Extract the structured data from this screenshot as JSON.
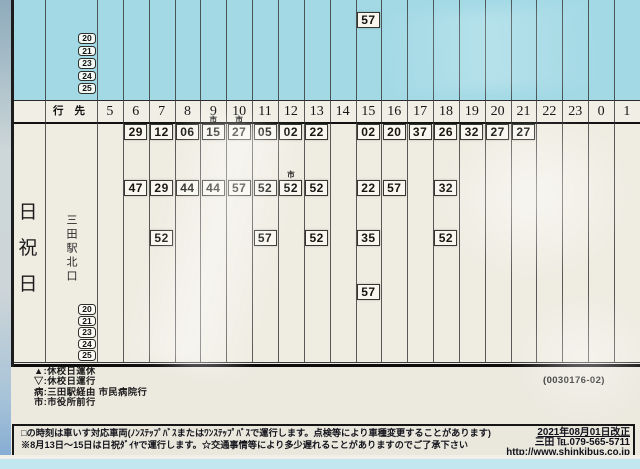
{
  "colors": {
    "cyan_section": "#a2d9e5",
    "paper": "#efece2",
    "header_paper": "#f1efe5",
    "time_box_fill": "#f8f6ee",
    "bottom_strip": "#c3e7f1"
  },
  "top_section": {
    "route_numbers": [
      "20",
      "21",
      "23",
      "24",
      "25"
    ],
    "times": [
      {
        "h": "15",
        "m": "57"
      }
    ]
  },
  "header": {
    "destination_label": "行 先",
    "hours": [
      "5",
      "6",
      "7",
      "8",
      "9",
      "10",
      "11",
      "12",
      "13",
      "14",
      "15",
      "16",
      "17",
      "18",
      "19",
      "20",
      "21",
      "22",
      "23",
      "0",
      "1"
    ]
  },
  "day_row": {
    "day_label": "日祝日",
    "day_label_chars": [
      "日",
      "祝",
      "日"
    ],
    "destination": "三田駅北口",
    "route_numbers": [
      "20",
      "21",
      "23",
      "24",
      "25"
    ],
    "time_rows": [
      [
        {
          "h": "6",
          "m": "29"
        },
        {
          "h": "7",
          "m": "12"
        },
        {
          "h": "8",
          "m": "06"
        },
        {
          "h": "9",
          "m": "15",
          "mark": "市"
        },
        {
          "h": "10",
          "m": "27",
          "mark": "市"
        },
        {
          "h": "11",
          "m": "05"
        },
        {
          "h": "12",
          "m": "02"
        },
        {
          "h": "13",
          "m": "22"
        },
        {
          "h": "15",
          "m": "02"
        },
        {
          "h": "16",
          "m": "20"
        },
        {
          "h": "17",
          "m": "37"
        },
        {
          "h": "18",
          "m": "26"
        },
        {
          "h": "19",
          "m": "32"
        },
        {
          "h": "20",
          "m": "27"
        },
        {
          "h": "21",
          "m": "27"
        }
      ],
      [
        {
          "h": "6",
          "m": "47"
        },
        {
          "h": "7",
          "m": "29"
        },
        {
          "h": "8",
          "m": "44"
        },
        {
          "h": "9",
          "m": "44"
        },
        {
          "h": "10",
          "m": "57"
        },
        {
          "h": "11",
          "m": "52"
        },
        {
          "h": "12",
          "m": "52",
          "mark": "市"
        },
        {
          "h": "13",
          "m": "52"
        },
        {
          "h": "15",
          "m": "22"
        },
        {
          "h": "16",
          "m": "57"
        },
        {
          "h": "18",
          "m": "32"
        }
      ],
      [
        {
          "h": "7",
          "m": "52"
        },
        {
          "h": "11",
          "m": "57"
        },
        {
          "h": "13",
          "m": "52"
        },
        {
          "h": "15",
          "m": "35"
        },
        {
          "h": "18",
          "m": "52"
        }
      ],
      [
        {
          "h": "15",
          "m": "57"
        }
      ]
    ]
  },
  "legend": {
    "items": [
      "▲:休校日運休",
      "▽:休校日運行",
      "病:三田駅経由 市民病院行",
      "市:市役所前行"
    ]
  },
  "serial": "(0030176-02)",
  "footer": {
    "note1": "□の時刻は車いす対応車両(ﾉﾝｽﾃｯﾌﾟﾊﾞｽまたはﾜﾝｽﾃｯﾌﾟﾊﾞｽで運行します。点検等により車種変更することがあります)",
    "note2": "※8月13日～15日は日祝ﾀﾞｲﾔで運行します。☆交通事情等により多少遅れることがありますのでご了承下さい",
    "revision": "2021年08月01日改正",
    "contact": "三田 ℡.079-565-5711",
    "url": "http://www.shinkibus.co.jp"
  }
}
